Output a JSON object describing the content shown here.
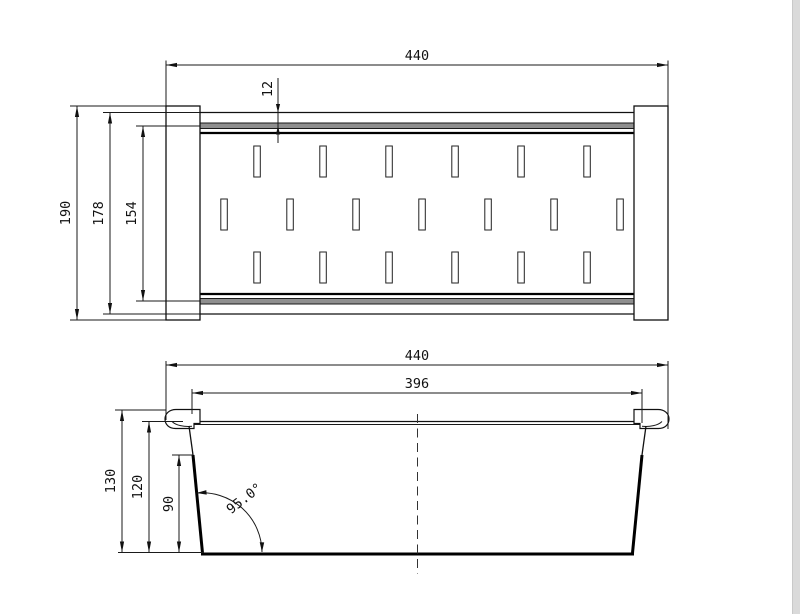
{
  "page": {
    "background": "#ffffff",
    "right_strip_color": "#dadada",
    "right_strip_edge_color": "#c9c9c9"
  },
  "drawing": {
    "line_color": "#1a1a1a",
    "rail_fill": "#8f8f8f",
    "top_view": {
      "title": "plan-view-of-sink-colander",
      "slot_rows": [
        6,
        7,
        6
      ],
      "dims": {
        "overall_length": "440",
        "rail_offset": "12",
        "overall_width": "190",
        "body_width": "178",
        "plate_width": "154"
      }
    },
    "side_view": {
      "title": "side-elevation-of-sink-colander",
      "dims": {
        "overall_length": "440",
        "inner_length": "396",
        "overall_height": "130",
        "rim_height": "120",
        "wall_height": "90",
        "wall_angle": "95.0°"
      }
    }
  }
}
